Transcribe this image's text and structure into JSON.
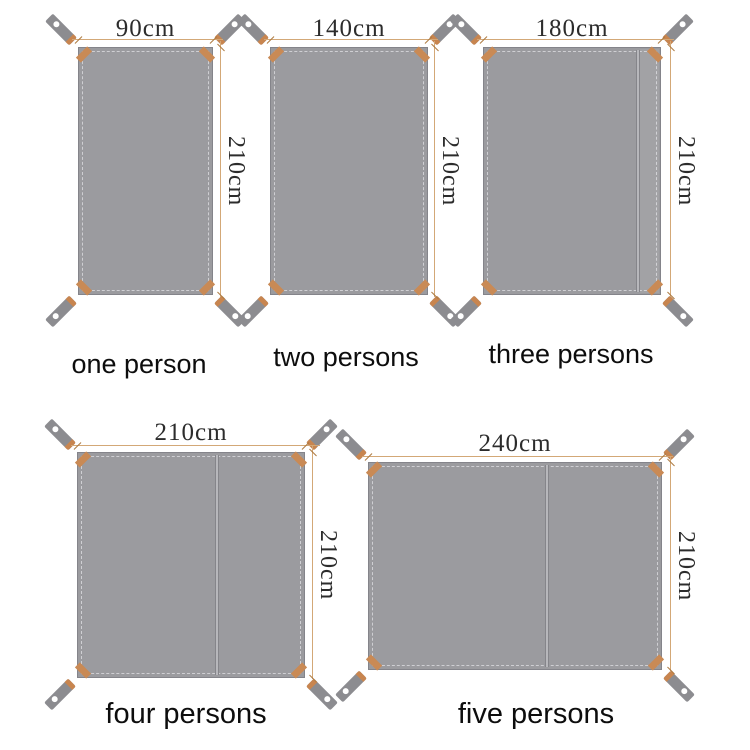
{
  "diagram": {
    "description": "ground mat size chart",
    "unit": "cm",
    "tarps": [
      {
        "caption": "one person",
        "width_label": "90cm",
        "height_label": "210cm",
        "width_cm": 90,
        "height_cm": 210,
        "has_seam": false
      },
      {
        "caption": "two persons",
        "width_label": "140cm",
        "height_label": "210cm",
        "width_cm": 140,
        "height_cm": 210,
        "has_seam": false
      },
      {
        "caption": "three persons",
        "width_label": "180cm",
        "height_label": "210cm",
        "width_cm": 180,
        "height_cm": 210,
        "has_seam": true
      },
      {
        "caption": "four persons",
        "width_label": "210cm",
        "height_label": "210cm",
        "width_cm": 210,
        "height_cm": 210,
        "has_seam": true
      },
      {
        "caption": "five persons",
        "width_label": "240cm",
        "height_label": "210cm",
        "width_cm": 240,
        "height_cm": 210,
        "has_seam": true
      }
    ],
    "colors": {
      "background": "#ffffff",
      "fabric": "#9b9b9f",
      "fabric_border": "#84848a",
      "stitch": "#cfcfd3",
      "strap": "#8c8c90",
      "strap_band": "#c8854f",
      "corner_patch": "#c98a55",
      "grommet": "#ffffff",
      "dimension_line": "#d3a877",
      "dimension_tick": "#ad7a40",
      "dimension_text": "#2c2c2c",
      "caption_text": "#0d0d0d"
    }
  }
}
